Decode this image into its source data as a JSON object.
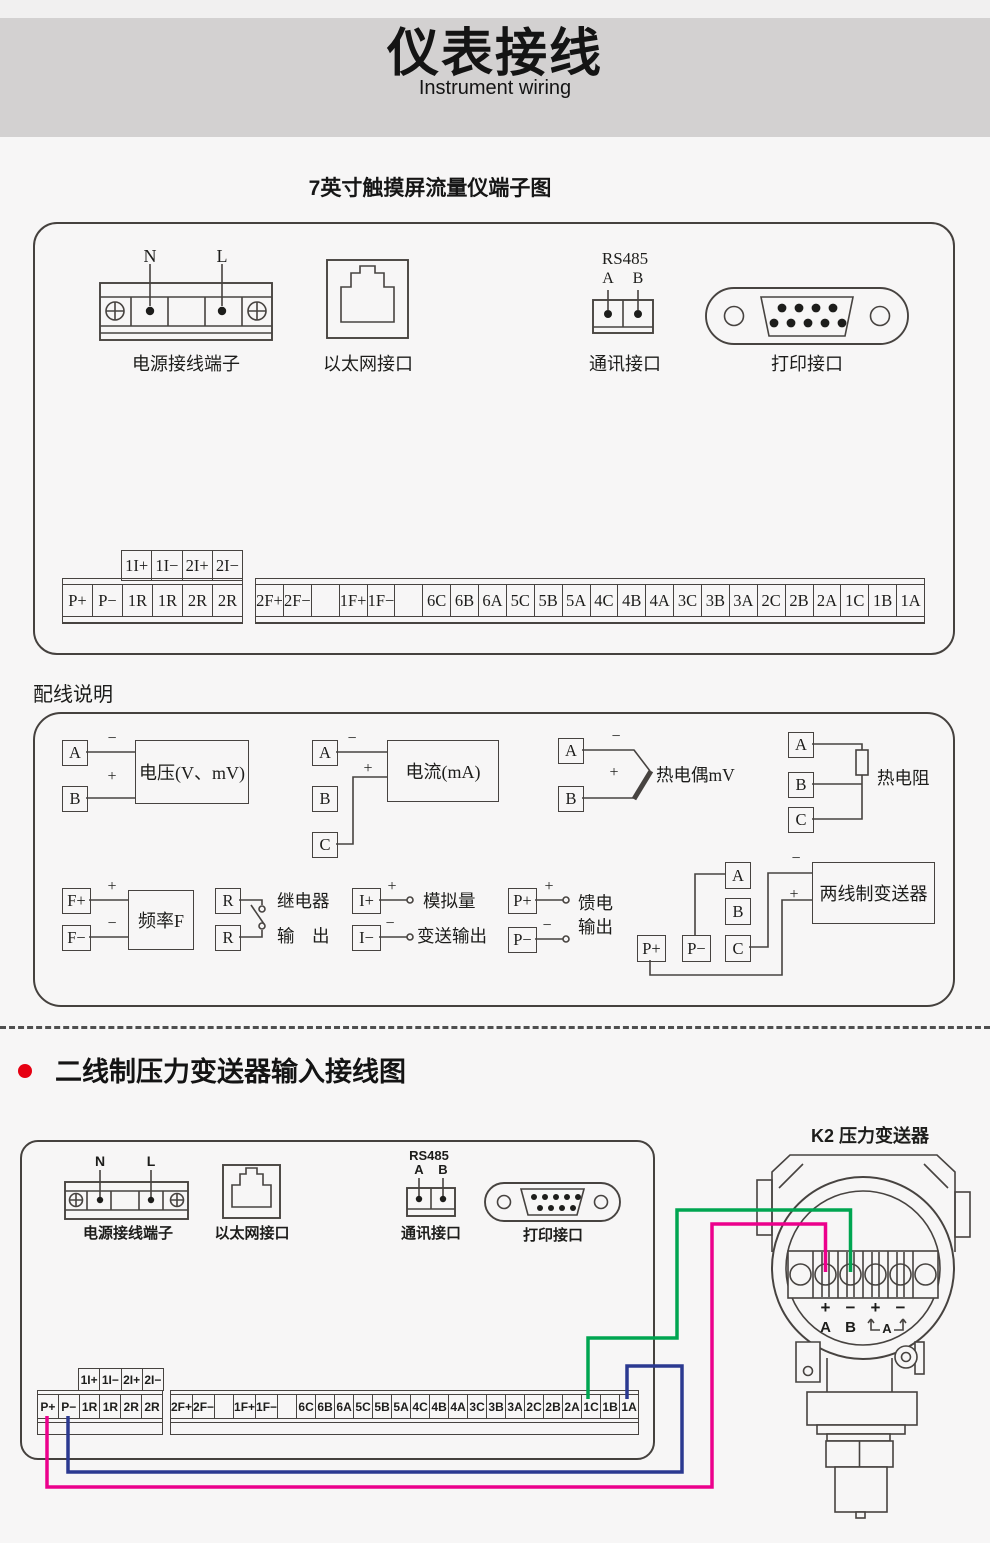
{
  "header": {
    "title": "仪表接线",
    "subtitle": "Instrument wiring",
    "band_color": "#d3d1d1"
  },
  "diagram1": {
    "title": "7英寸触摸屏流量仪端子图",
    "power": {
      "n": "N",
      "l": "L",
      "label": "电源接线端子"
    },
    "ethernet": {
      "label": "以太网接口"
    },
    "comm": {
      "name": "RS485",
      "a": "A",
      "b": "B",
      "label": "通讯接口"
    },
    "printer": {
      "label": "打印接口"
    },
    "aux_terminals": [
      "1I+",
      "1I−",
      "2I+",
      "2I−"
    ],
    "left_terminals": [
      "P+",
      "P−",
      "1R",
      "1R",
      "2R",
      "2R"
    ],
    "right_terminals": [
      "2F+",
      "2F−",
      "",
      "1F+",
      "1F−",
      "",
      "6C",
      "6B",
      "6A",
      "5C",
      "5B",
      "5A",
      "4C",
      "4B",
      "4A",
      "3C",
      "3B",
      "3A",
      "2C",
      "2B",
      "2A",
      "1C",
      "1B",
      "1A"
    ]
  },
  "wiring": {
    "heading": "配线说明",
    "signs": {
      "plus": "+",
      "minus": "−"
    },
    "voltage": {
      "a": "A",
      "b": "B",
      "label": "电压(V、mV)"
    },
    "current": {
      "a": "A",
      "b": "B",
      "c": "C",
      "label": "电流(mA)"
    },
    "thermocouple": {
      "a": "A",
      "b": "B",
      "label": "热电偶mV"
    },
    "rtd": {
      "a": "A",
      "b": "B",
      "c": "C",
      "label": "热电阻"
    },
    "frequency": {
      "plus": "F+",
      "minus": "F−",
      "label": "频率F"
    },
    "relay": {
      "r1": "R",
      "r2": "R",
      "line1": "继电器",
      "line2": "输　出"
    },
    "analog": {
      "plus": "I+",
      "minus": "I−",
      "line1": "模拟量",
      "line2": "变送输出"
    },
    "feed": {
      "plus": "P+",
      "minus": "P−",
      "line1": "馈电",
      "line2": "输出"
    },
    "twowire": {
      "pplus": "P+",
      "pminus": "P−",
      "a": "A",
      "b": "B",
      "c": "C",
      "label": "两线制变送器"
    }
  },
  "diagram2": {
    "title": "二线制压力变送器输入接线图",
    "bullet_color": "#e60012",
    "k2_label": "K2  压力变送器",
    "power": {
      "n": "N",
      "l": "L",
      "label": "电源接线端子"
    },
    "ethernet": {
      "label": "以太网接口"
    },
    "comm": {
      "name": "RS485",
      "a": "A",
      "b": "B",
      "label": "通讯接口"
    },
    "printer": {
      "label": "打印接口"
    },
    "aux_terminals": [
      "1I+",
      "1I−",
      "2I+",
      "2I−"
    ],
    "left_terminals": [
      "P+",
      "P−",
      "1R",
      "1R",
      "2R",
      "2R"
    ],
    "right_terminals": [
      "2F+",
      "2F−",
      "",
      "1F+",
      "1F−",
      "",
      "6C",
      "6B",
      "6A",
      "5C",
      "5B",
      "5A",
      "4C",
      "4B",
      "4A",
      "3C",
      "3B",
      "3A",
      "2C",
      "2B",
      "2A",
      "1C",
      "1B",
      "1A"
    ],
    "transmitter": {
      "plus1": "+",
      "minus1": "−",
      "plus2": "+",
      "minus2": "−",
      "a": "A",
      "b": "B",
      "loop": "A"
    },
    "wire_colors": {
      "green": "#00a551",
      "pink": "#ec008c",
      "blue": "#2b3990"
    }
  }
}
